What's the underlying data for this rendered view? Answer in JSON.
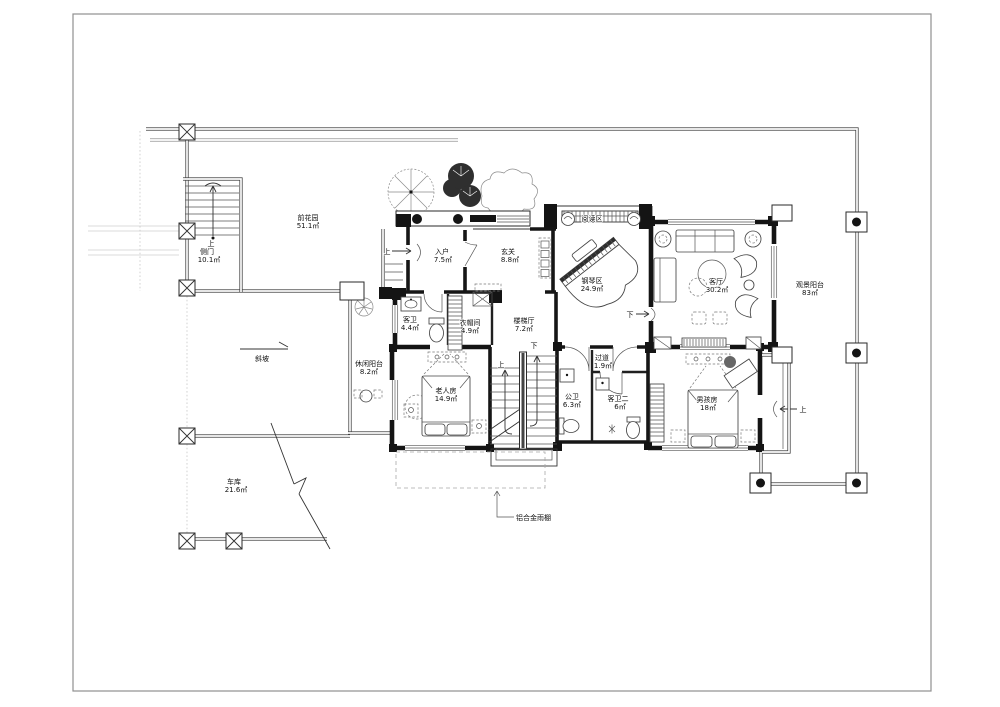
{
  "rooms": {
    "front_garden": {
      "name": "前花园",
      "area": "51.1㎡"
    },
    "side_gate": {
      "name": "侧门",
      "area": "10.1㎡"
    },
    "entry": {
      "name": "入户",
      "area": "7.5㎡"
    },
    "foyer": {
      "name": "玄关",
      "area": "8.8㎡"
    },
    "reading_area": {
      "name": "阅读区"
    },
    "piano_area": {
      "name": "钢琴区",
      "area": "24.9㎡"
    },
    "living_room": {
      "name": "客厅",
      "area": "30.2㎡"
    },
    "view_balcony": {
      "name": "观景阳台",
      "area": "83㎡"
    },
    "guest_bath": {
      "name": "客卫",
      "area": "4.4㎡"
    },
    "cloakroom": {
      "name": "衣帽间",
      "area": "4.9㎡"
    },
    "stair_hall": {
      "name": "楼梯厅",
      "area": "7.2㎡"
    },
    "leisure_balcony": {
      "name": "休闲阳台",
      "area": "8.2㎡"
    },
    "elder_room": {
      "name": "老人房",
      "area": "14.9㎡"
    },
    "public_bath": {
      "name": "公卫",
      "area": "6.3㎡"
    },
    "corridor": {
      "name": "过道",
      "area": "1.9㎡"
    },
    "guest_bath_2": {
      "name": "客卫二",
      "area": "6㎡"
    },
    "boys_room": {
      "name": "男孩房",
      "area": "18㎡"
    },
    "garage": {
      "name": "车库",
      "area": "21.6㎡"
    }
  },
  "labels": {
    "up": "上",
    "down": "下"
  },
  "annotations": {
    "slope": "斜坡",
    "canopy": "铝合金雨棚"
  },
  "colors": {
    "line": "#1a1a1a",
    "wall": "#141414",
    "faint": "#c8c8c8"
  }
}
